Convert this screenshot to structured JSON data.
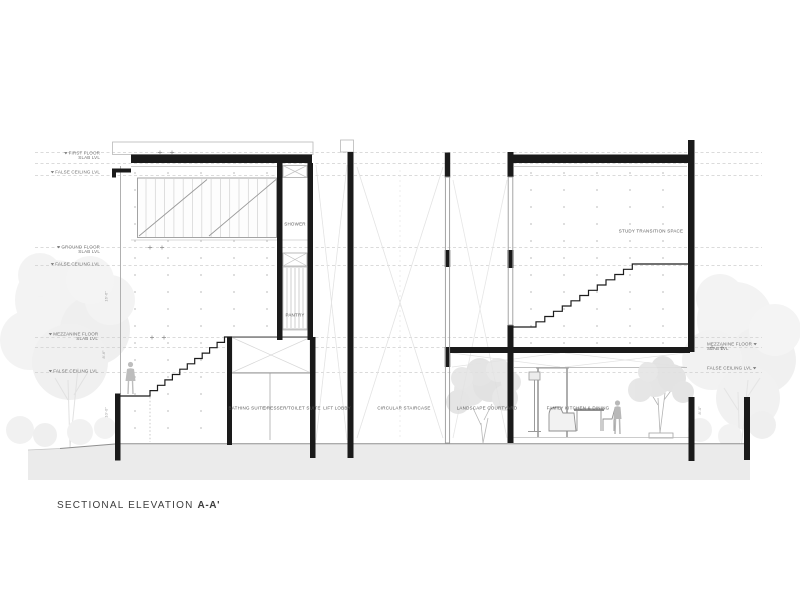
{
  "title": {
    "text": "SECTIONAL ELEVATION",
    "mark": "A-A'"
  },
  "rooms": {
    "shower": "SHOWER",
    "pantry": "PANTRY",
    "bathing_suite": "BATHING SUITE",
    "dresser_toilet_suite": "DRESSER/TOILET SUITE",
    "lift_lobby": "LIFT LOBBY",
    "circular_staircase": "CIRCULAR STAIRCASE",
    "landscape_courtyard": "LANDSCAPE COURTYARD",
    "family_kitchen_dining": "FAMILY KITCHEN & DINING",
    "study_transition_space": "STUDY TRANSITION SPACE"
  },
  "levels_left": [
    {
      "line1": "FIRST FLOOR",
      "line2": "SLAB LVL"
    },
    {
      "line1": "FALSE CEILING LVL",
      "line2": ""
    },
    {
      "line1": "GROUND FLOOR",
      "line2": "SLAB LVL"
    },
    {
      "line1": "FALSE CEILING LVL",
      "line2": ""
    },
    {
      "line1": "MEZZANINE FLOOR",
      "line2": "SLAB LVL"
    },
    {
      "line1": "FALSE CEILING LVL",
      "line2": ""
    }
  ],
  "levels_right": [
    {
      "line1": "MEZZANINE FLOOR",
      "line2": "SLAB LVL"
    },
    {
      "line1": "FALSE CEILING LVL",
      "line2": ""
    }
  ],
  "dims": {
    "v1": "16'-6\"",
    "v2": "8'-6\"",
    "v3": "10'-0\"",
    "v4": "8'-0\""
  },
  "colors": {
    "ink": "#1a1a1a",
    "line_gray": "#9a9a9a",
    "faint": "#e2e2e2",
    "ground_fill": "#ebebeb",
    "tree_gray": "#dcdcdc"
  }
}
